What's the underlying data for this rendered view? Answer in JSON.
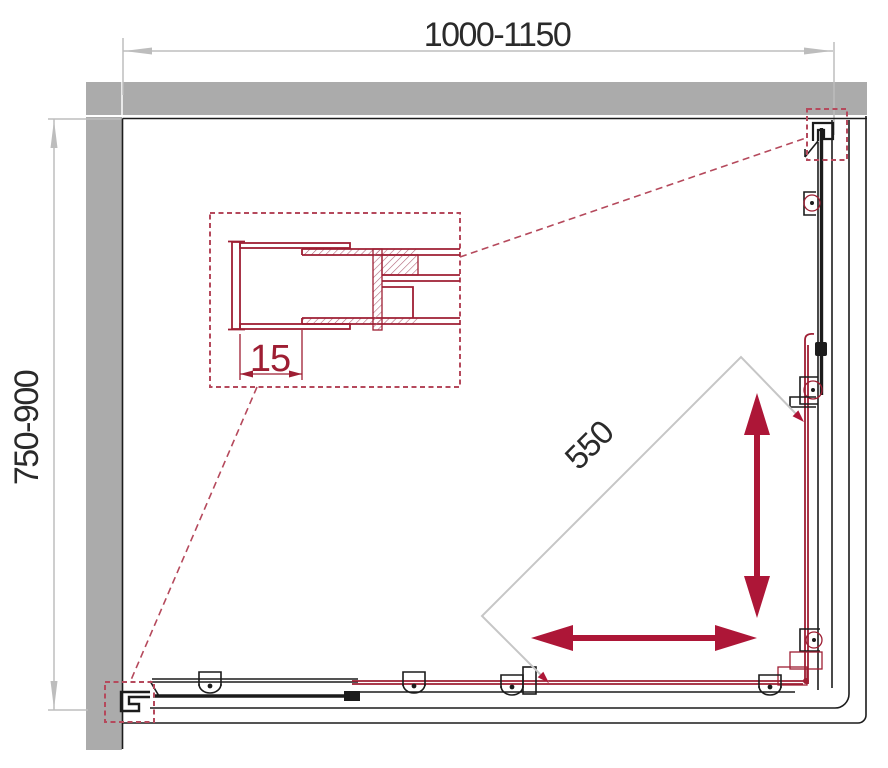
{
  "drawing": {
    "dimensions": {
      "width": {
        "label": "1000-1150"
      },
      "depth": {
        "label": "750-900"
      },
      "opening": {
        "label": "550"
      },
      "profile": {
        "label": "15"
      }
    }
  },
  "colors": {
    "bg": "#ffffff",
    "wall_gray": "#ababab",
    "line_dark": "#1c1c1c",
    "crimson": "#9e1e33",
    "arrow_red": "#ad1637",
    "leader_red": "#b5495c",
    "dim_gray": "#bdbdbd",
    "text_dark": "#2a2a2a"
  }
}
